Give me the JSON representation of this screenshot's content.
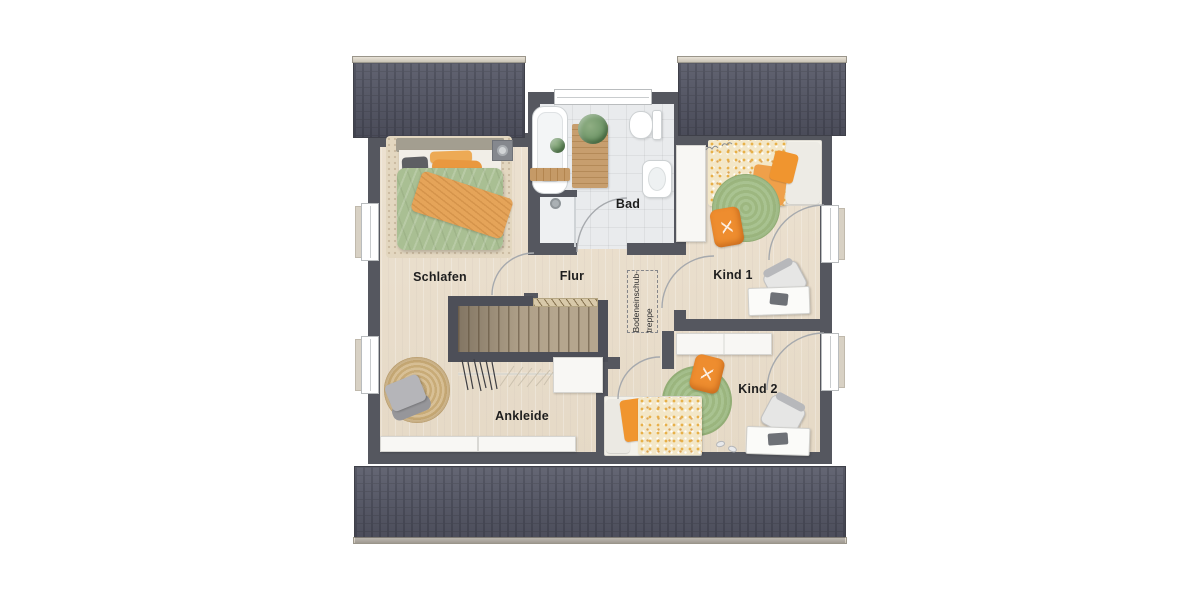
{
  "rooms": {
    "schlafen": "Schlafen",
    "bad": "Bad",
    "flur": "Flur",
    "kind1": "Kind 1",
    "kind2": "Kind 2",
    "ankleide": "Ankleide"
  },
  "attic": {
    "line1": "Bodeneinschub-",
    "line2": "treppe"
  },
  "colors": {
    "wall": "#55575f",
    "roof": "#5b5d6b",
    "roof-stripe": "#4d4f5c",
    "floor-wood": "#e9decd",
    "floor-tile": "#e9ebed",
    "duvet-green": "#a9bf93",
    "orange": "#ee8d2f",
    "wood-stairs": "#b5a68e",
    "label": "#1e1e1e"
  }
}
